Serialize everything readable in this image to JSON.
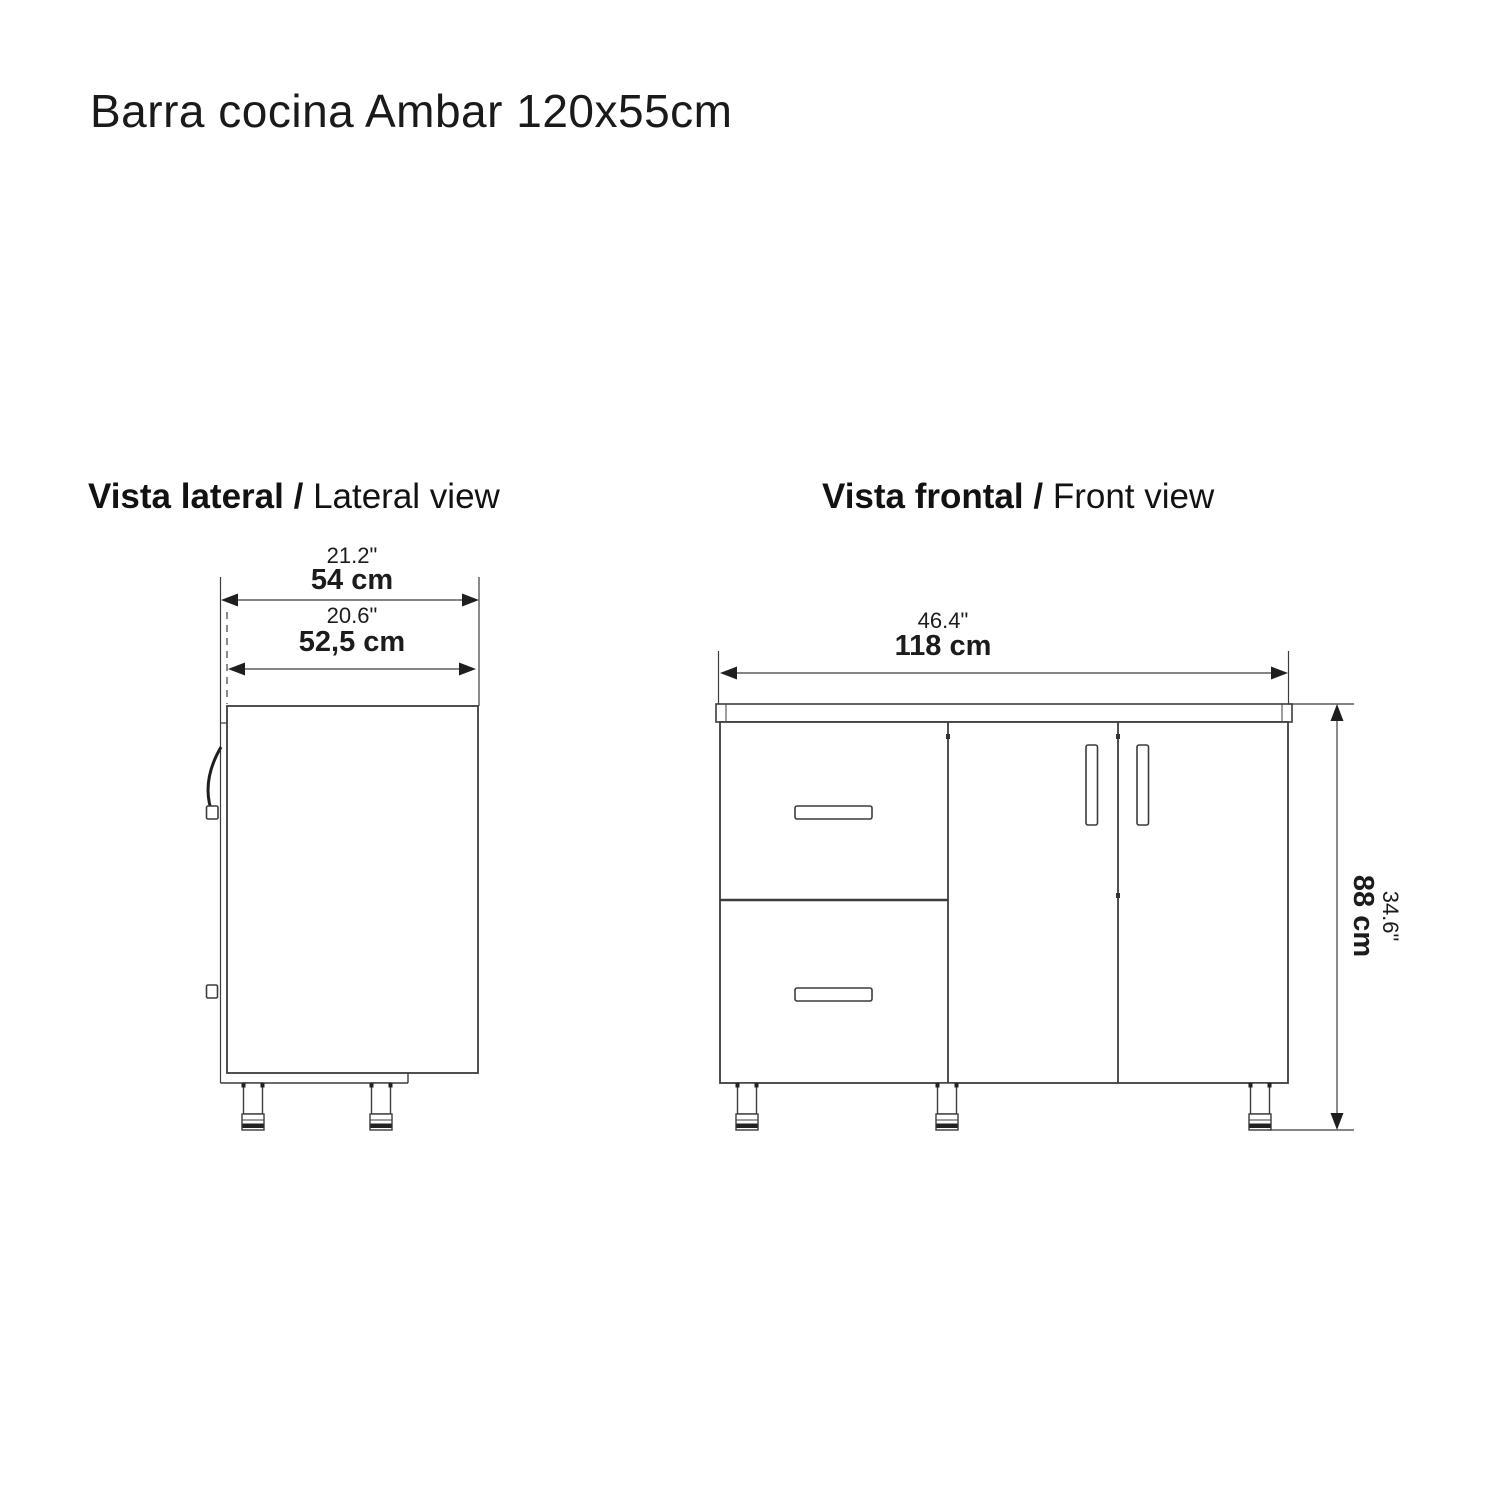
{
  "page": {
    "title": "Barra cocina Ambar 120x55cm"
  },
  "lateral": {
    "heading_bold": "Vista lateral /",
    "heading_regular": "Lateral view",
    "dim_depth_in": "21.2\"",
    "dim_depth_cm": "54 cm",
    "dim_inner_depth_in": "20.6\"",
    "dim_inner_depth_cm": "52,5 cm"
  },
  "frontal": {
    "heading_bold": "Vista frontal /",
    "heading_regular": "Front view",
    "dim_width_in": "46.4\"",
    "dim_width_cm": "118 cm",
    "dim_height_in": "34.6\"",
    "dim_height_cm": "88 cm"
  },
  "colors": {
    "line": "#3c3c3c",
    "accent_dark": "#222222",
    "text": "#1c1c1c",
    "background": "#ffffff"
  }
}
